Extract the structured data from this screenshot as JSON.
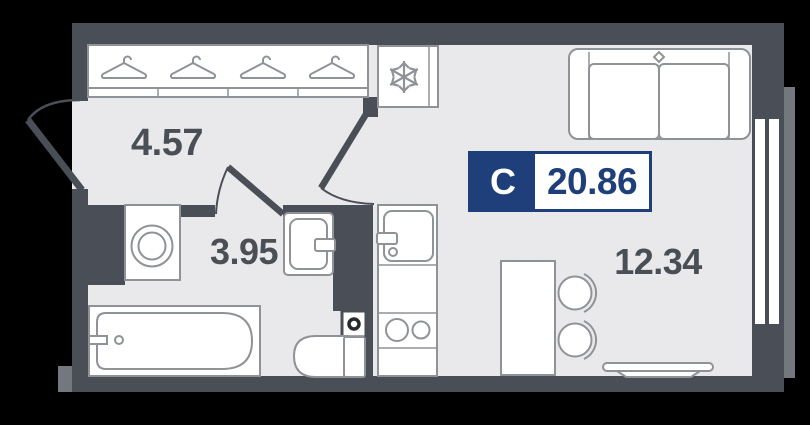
{
  "badge": {
    "unit_type": "С",
    "total_area": "20.86"
  },
  "rooms": {
    "hallway": {
      "area": "4.57"
    },
    "bathroom": {
      "area": "3.95"
    },
    "living_kitchen": {
      "area": "12.34"
    }
  },
  "icons": {
    "wardrobe": "hanger-icon",
    "fridge": "snowflake-icon",
    "bathroom": [
      "washing-machine-icon",
      "sink-icon",
      "bathtub-icon",
      "toilet-icon",
      "shaft-icon"
    ],
    "kitchen": [
      "kitchen-sink-icon",
      "stove-burners-icon"
    ],
    "living": [
      "sofa-icon",
      "table-icon",
      "chair-icon",
      "console-shelf-icon",
      "window"
    ]
  },
  "colors": {
    "background": "#000000",
    "wall": "#4a4e57",
    "floor": "#e9e9eb",
    "furniture_stroke": "#8f9297",
    "accent_navy": "#1f3f7a",
    "label_text": "#4a4e55",
    "outer_ledge": "#74777d"
  }
}
